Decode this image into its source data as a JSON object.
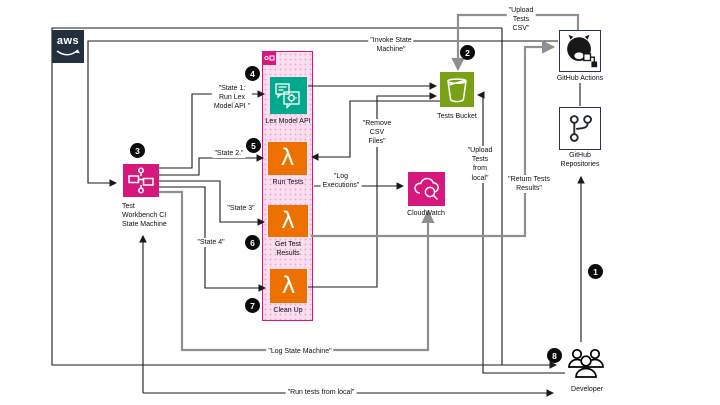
{
  "nodes": {
    "aws_logo": {
      "label": "aws"
    },
    "state_machine": {
      "badge": "3",
      "label": "Test\nWorkbench CI\nState Machine"
    },
    "lex_model_api": {
      "badge": "4",
      "label": "Lex Model API"
    },
    "run_tests": {
      "badge": "5",
      "label": "Run Tests"
    },
    "get_test_results": {
      "badge": "6",
      "label": "Get Test\nResults"
    },
    "clean_up": {
      "badge": "7",
      "label": "Clean Up"
    },
    "tests_bucket": {
      "badge": "2",
      "label": "Tests Bucket"
    },
    "cloudwatch": {
      "label": "CloudWatch"
    },
    "github_actions": {
      "label": "GitHub Actions"
    },
    "github_repositories": {
      "label": "GitHub\nRepositories"
    },
    "developer": {
      "badge": "8",
      "label": "Developer"
    },
    "step_badge_1": {
      "badge": "1"
    }
  },
  "edge_labels": {
    "invoke_state_machine": "\"Invoke State\nMachine\"",
    "upload_tests_csv": "\"Upload\nTests\nCSV\"",
    "state_1": "\"State 1:\nRun Lex\nModel API \"",
    "state_2": "\"State 2.\"",
    "state_3": "\"State 3\"",
    "state_4": "\"State 4\"",
    "remove_csv_files": "\"Remove\nCSV\nFiles\"",
    "log_executions": "\"Log\nExecutions\"",
    "upload_tests_from_local": "\"Upload\nTests\nfrom\nlocal\"",
    "return_tests_results": "\"Return Tests\nResults\"",
    "log_state_machine": "\"Log State Machine\"",
    "run_tests_from_local": "\"Run tests from local\""
  },
  "colors": {
    "pink": "#D6187C",
    "pink_fill": "#FBDFF0",
    "lambda_orange": "#ED7100",
    "s3_green": "#7AA116",
    "lex_teal": "#01A88D",
    "aws_navy": "#232F3E",
    "github_navy": "#27354F",
    "gray_line": "#8f8f8f",
    "black_line": "#1a1a1a"
  }
}
